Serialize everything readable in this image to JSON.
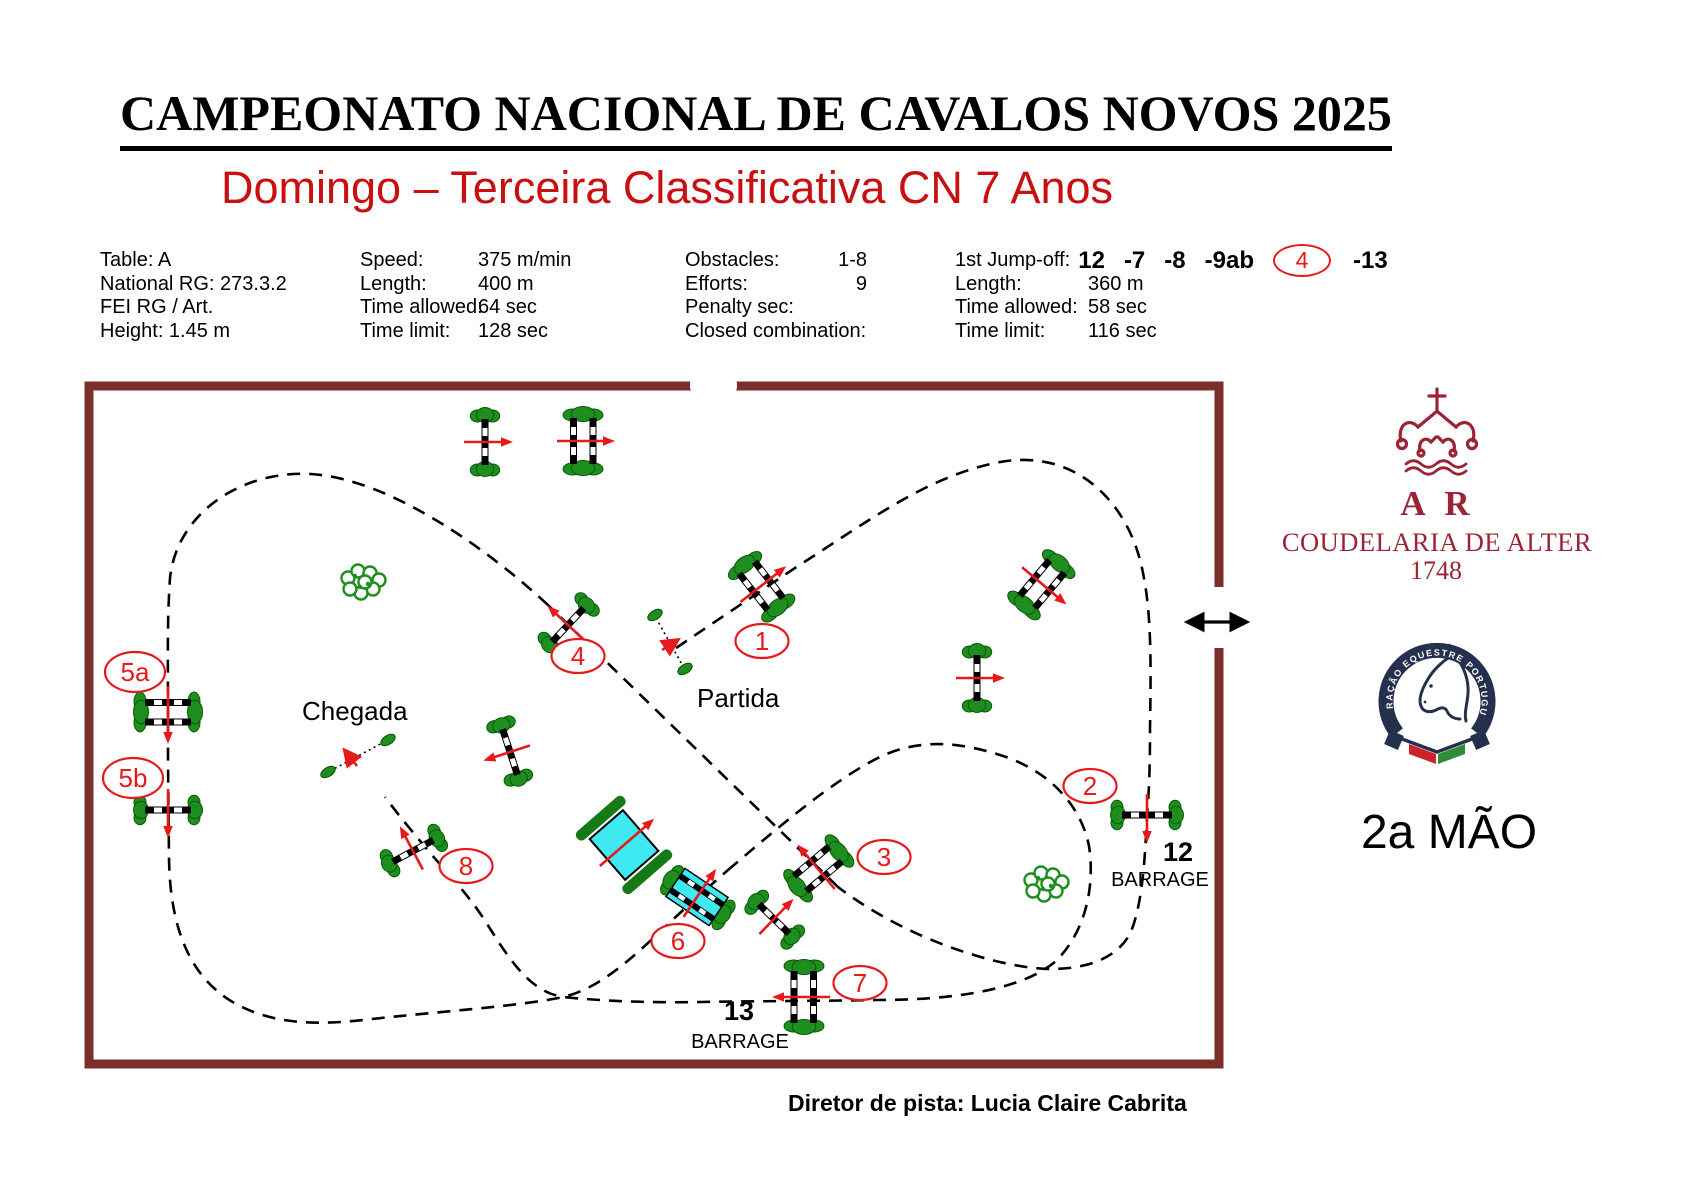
{
  "header": {
    "title": "CAMPEONATO NACIONAL DE CAVALOS NOVOS 2025",
    "subtitle": "Domingo – Terceira Classificativa CN 7 Anos"
  },
  "info": {
    "general": [
      "Table: A",
      "National RG: 273.3.2",
      "FEI RG / Art.",
      "Height: 1.45 m"
    ],
    "course": [
      {
        "label": "Speed:",
        "value": "375 m/min"
      },
      {
        "label": "Length:",
        "value": "400 m"
      },
      {
        "label": "Time allowed:",
        "value": "64 sec"
      },
      {
        "label": "Time limit:",
        "value": "128 sec"
      }
    ],
    "obstacles": [
      {
        "label": "Obstacles:",
        "value": "1-8"
      },
      {
        "label": "Efforts:",
        "value": "9"
      },
      {
        "label": "Penalty sec:",
        "value": ""
      },
      {
        "label": "Closed combination:",
        "value": ""
      }
    ],
    "jumpoff": {
      "label": "1st Jump-off:",
      "seq": [
        "12",
        "-7",
        "-8",
        "-9ab"
      ],
      "circled": "4",
      "last": "-13",
      "rows": [
        {
          "label": "Length:",
          "value": "360 m"
        },
        {
          "label": "Time allowed:",
          "value": "58 sec"
        },
        {
          "label": "Time limit:",
          "value": "116 sec"
        }
      ]
    }
  },
  "arena": {
    "labels": {
      "start": "Partida",
      "finish": "Chegada",
      "barrage12_num": "12",
      "barrage12": "BARRAGE",
      "barrage13_num": "13",
      "barrage13": "BARRAGE"
    },
    "obstacles": [
      "1",
      "2",
      "3",
      "4",
      "5a",
      "5b",
      "6",
      "7",
      "8"
    ]
  },
  "logos": {
    "alter": {
      "initials": "A R",
      "name": "COUDELARIA DE ALTER",
      "year": "1748"
    },
    "fep_ring": "FEDERAÇÃO EQUESTRE PORTUGUESA",
    "hand": "2a MÃO"
  },
  "footer": {
    "director": "Diretor de pista: Lucia Claire Cabrita"
  },
  "colors": {
    "course_red": "#e61a1a",
    "arena_border": "#7b2f28",
    "bush_green": "#1e8e1e",
    "bank_green": "#157a15",
    "water_cyan": "#3fe9f2",
    "alter_red": "#9b2335",
    "fep_navy": "#24304e",
    "subtitle_red": "#c90f0f"
  }
}
